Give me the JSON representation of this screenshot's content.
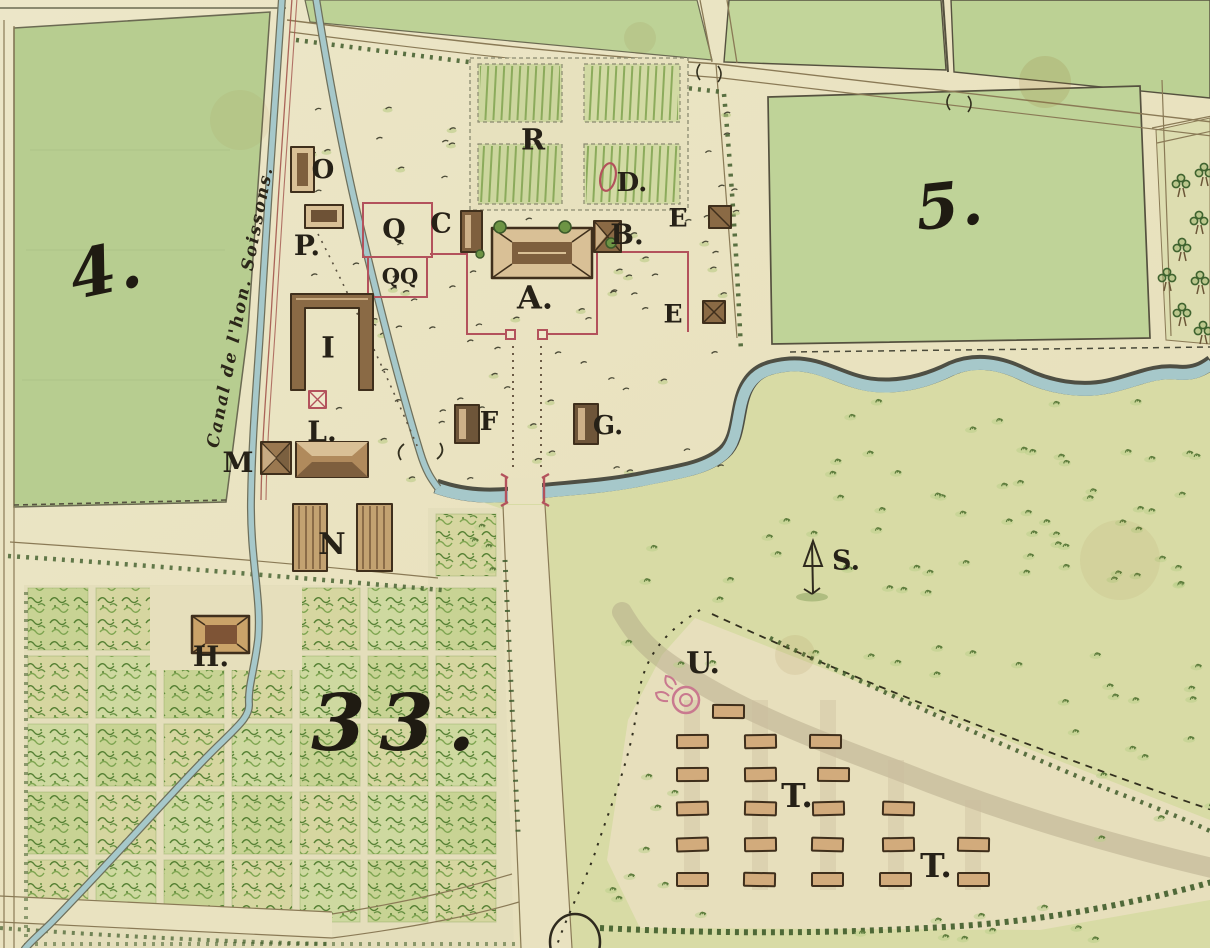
{
  "map": {
    "colors": {
      "paper": "#ebe4c4",
      "field_green": "#b7cd90",
      "field_green_bright": "#c2d59a",
      "meadow_green": "#d8dba5",
      "orchard_base": "#e4debb",
      "water_blue": "#a6c8ca",
      "stream_edge": "#4e4f44",
      "road_line": "#8a7a56",
      "hedge_green": "#3f5c2a",
      "building_outline": "#3f2f1c",
      "building_roof": "#8a6a45",
      "building_light": "#d9c096",
      "camp_building_fill": "#d2ab7c",
      "boundary_red": "#b3525c",
      "feature_pink": "#c9798f",
      "ink": "#262117"
    },
    "canal_label": {
      "text": "Canal de l'hon. Soissons.",
      "x": 241,
      "y": 307,
      "rotate": -79,
      "size": 17
    },
    "region_labels": [
      {
        "id": "field-4",
        "text": "4.",
        "x": 106,
        "y": 272,
        "size": 66,
        "rotate": -12,
        "letter_spacing": 2
      },
      {
        "id": "field-5",
        "text": "5.",
        "x": 950,
        "y": 208,
        "size": 62,
        "rotate": -6,
        "letter_spacing": 2
      },
      {
        "id": "parcel-33",
        "text": "33.",
        "x": 400,
        "y": 727,
        "size": 78,
        "rotate": 0,
        "letter_spacing": 14
      }
    ],
    "markers": [
      {
        "id": "o",
        "text": "O",
        "x": 323,
        "y": 171,
        "size": 26
      },
      {
        "id": "p",
        "text": "P.",
        "x": 307,
        "y": 247,
        "size": 28
      },
      {
        "id": "q",
        "text": "Q",
        "x": 394,
        "y": 231,
        "size": 27
      },
      {
        "id": "qq",
        "text": "QQ",
        "x": 400,
        "y": 277,
        "size": 21
      },
      {
        "id": "c",
        "text": "C",
        "x": 441,
        "y": 225,
        "size": 27
      },
      {
        "id": "a",
        "text": "A.",
        "x": 535,
        "y": 299,
        "size": 32
      },
      {
        "id": "b",
        "text": "B.",
        "x": 627,
        "y": 236,
        "size": 28
      },
      {
        "id": "d",
        "text": "D.",
        "x": 632,
        "y": 184,
        "size": 26
      },
      {
        "id": "e1",
        "text": "E",
        "x": 678,
        "y": 219,
        "size": 25
      },
      {
        "id": "e2",
        "text": "E",
        "x": 673,
        "y": 315,
        "size": 25
      },
      {
        "id": "r",
        "text": "R",
        "x": 533,
        "y": 141,
        "size": 29
      },
      {
        "id": "i",
        "text": "I",
        "x": 328,
        "y": 349,
        "size": 29
      },
      {
        "id": "l",
        "text": "L.",
        "x": 322,
        "y": 433,
        "size": 28
      },
      {
        "id": "m",
        "text": "M",
        "x": 238,
        "y": 464,
        "size": 28
      },
      {
        "id": "n",
        "text": "N",
        "x": 332,
        "y": 546,
        "size": 30
      },
      {
        "id": "f",
        "text": "F",
        "x": 489,
        "y": 423,
        "size": 26
      },
      {
        "id": "g",
        "text": "G.",
        "x": 608,
        "y": 427,
        "size": 26
      },
      {
        "id": "h",
        "text": "H.",
        "x": 211,
        "y": 658,
        "size": 28
      },
      {
        "id": "s",
        "text": "S.",
        "x": 846,
        "y": 562,
        "size": 27
      },
      {
        "id": "u",
        "text": "U.",
        "x": 703,
        "y": 665,
        "size": 30
      },
      {
        "id": "t1",
        "text": "T.",
        "x": 797,
        "y": 797,
        "size": 33
      },
      {
        "id": "t2",
        "text": "T.",
        "x": 936,
        "y": 867,
        "size": 33
      }
    ],
    "camp": {
      "building_width": 31,
      "building_height": 13,
      "buildings": [
        [
          713,
          705
        ],
        [
          677,
          735
        ],
        [
          745,
          735
        ],
        [
          810,
          735
        ],
        [
          677,
          768
        ],
        [
          745,
          768
        ],
        [
          818,
          768
        ],
        [
          677,
          802
        ],
        [
          745,
          802
        ],
        [
          813,
          802
        ],
        [
          883,
          802
        ],
        [
          677,
          838
        ],
        [
          745,
          838
        ],
        [
          812,
          838
        ],
        [
          883,
          838
        ],
        [
          958,
          838
        ],
        [
          677,
          873
        ],
        [
          744,
          873
        ],
        [
          812,
          873
        ],
        [
          880,
          873
        ],
        [
          958,
          873
        ]
      ]
    },
    "roadside_trees": [
      [
        1181,
        183
      ],
      [
        1204,
        172
      ],
      [
        1199,
        220
      ],
      [
        1182,
        247
      ],
      [
        1167,
        277
      ],
      [
        1200,
        280
      ],
      [
        1182,
        312
      ],
      [
        1203,
        330
      ]
    ]
  }
}
